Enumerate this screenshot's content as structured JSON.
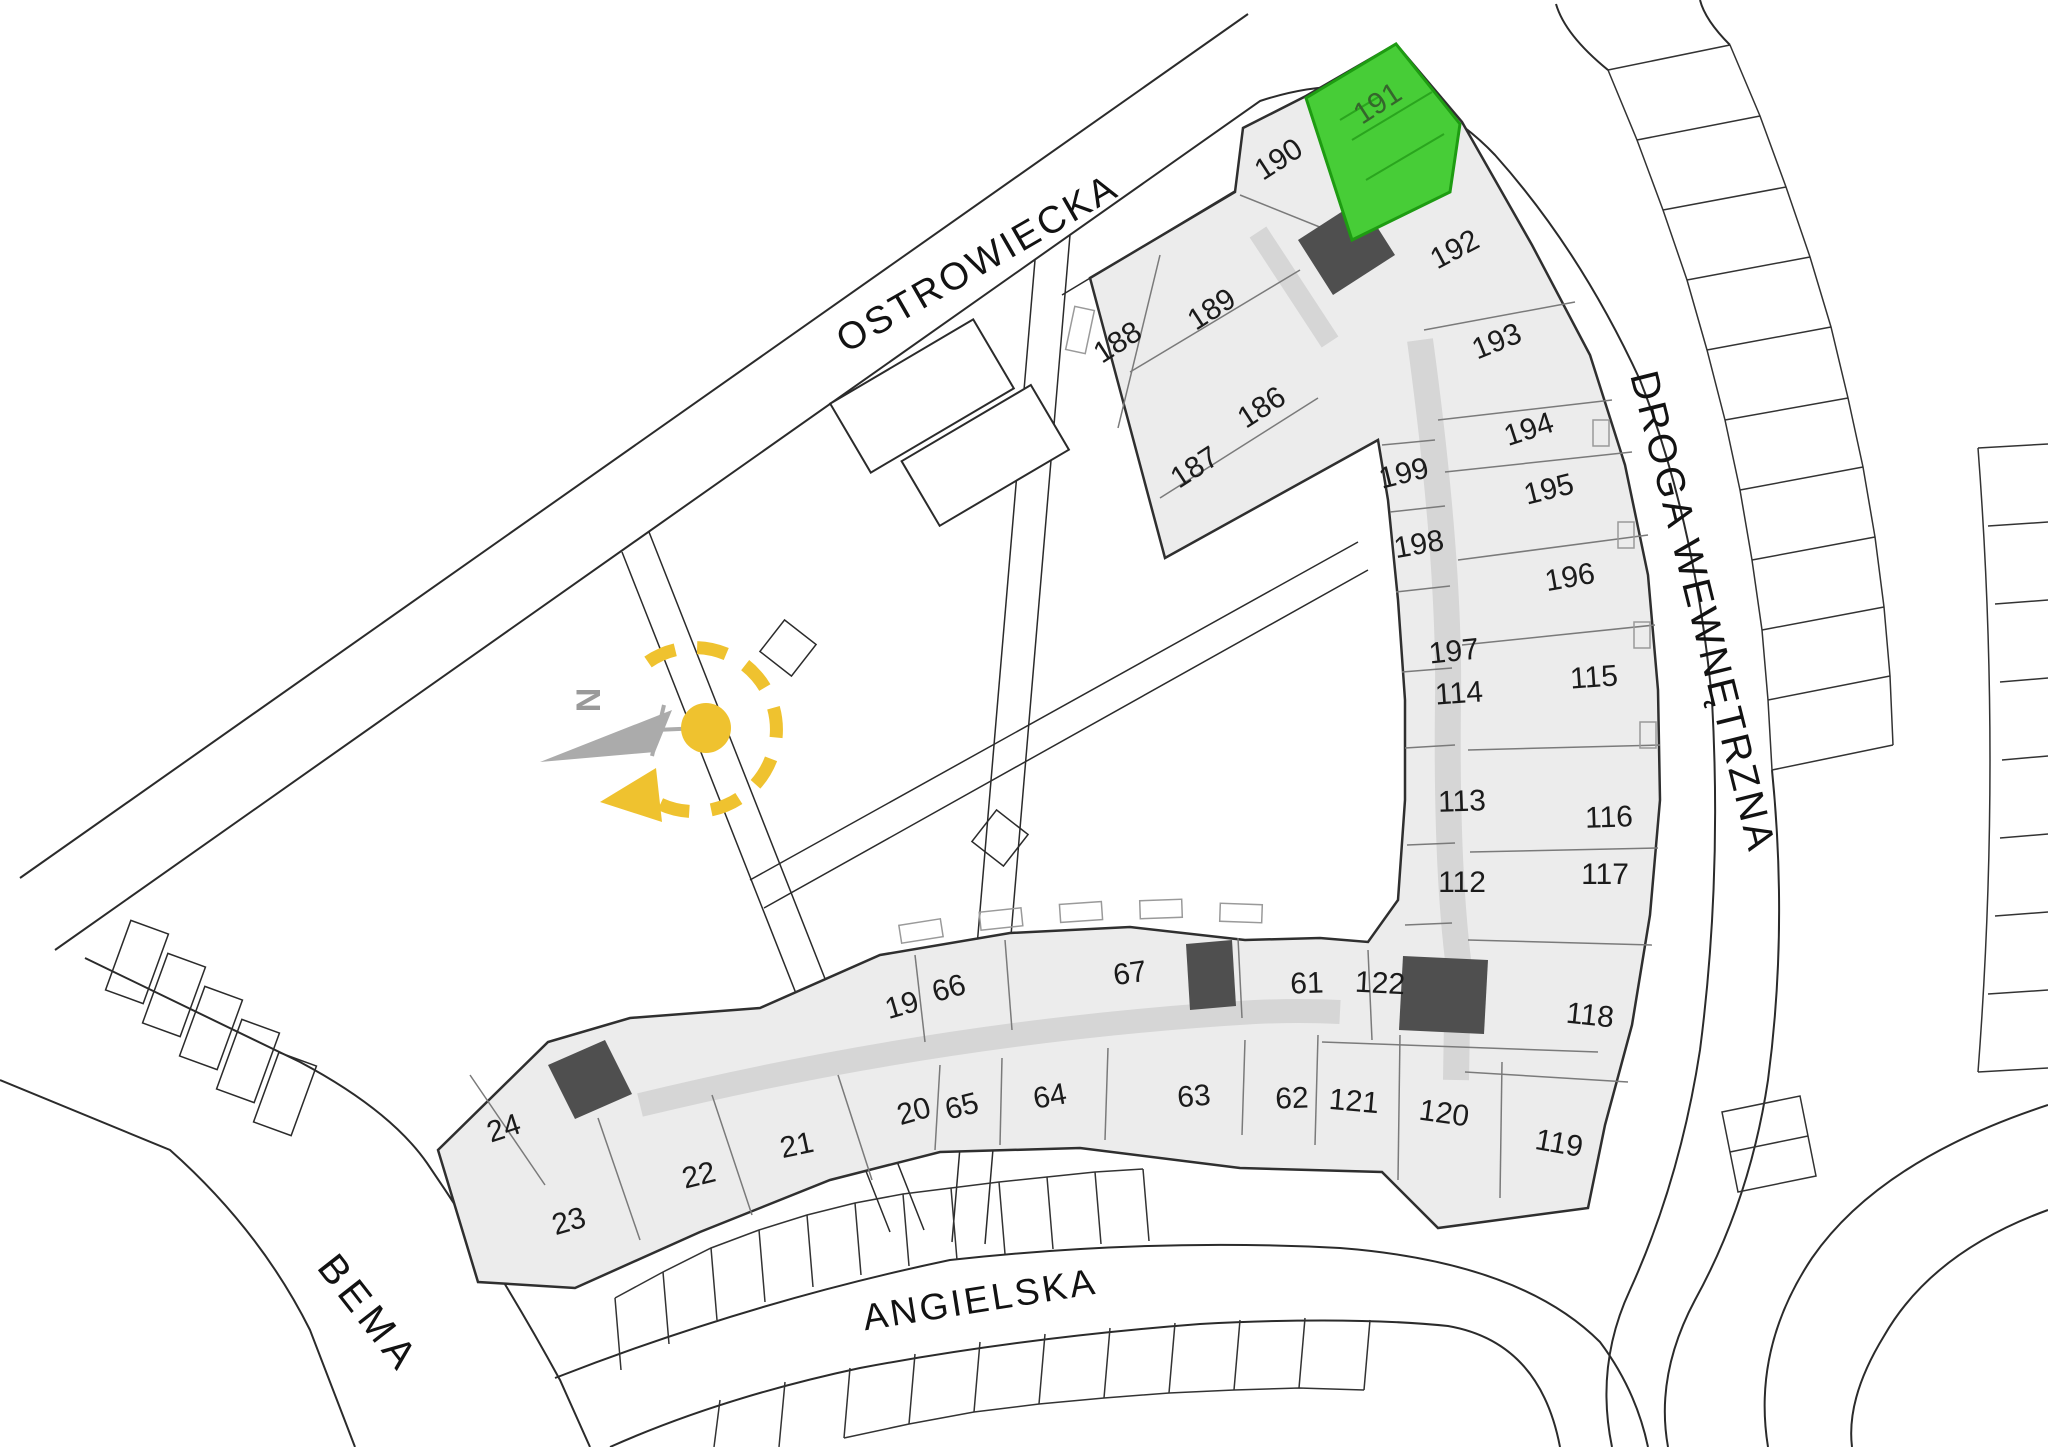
{
  "plan": {
    "type": "residential-site-plan",
    "width": 2048,
    "height": 1447
  },
  "highlighted_unit": {
    "number": "191"
  },
  "compass": {
    "north_label": "N"
  },
  "colors": {
    "highlight_fill": "#47CD37",
    "highlight_stroke": "#1E9C12",
    "highlight_label": "#35662C",
    "compass_accent": "#EFC22F",
    "building_fill": "#ECECEC",
    "wall": "#2F2F2F",
    "label": "#1B1B1B",
    "line": "#2B2B2B"
  },
  "streets": [
    {
      "name": "ostrowiecka",
      "label": "OSTROWIECKA",
      "x": 978,
      "y": 264,
      "rot": -30,
      "size": 38,
      "spacing": 3
    },
    {
      "name": "droga-wewnetrzna",
      "label": "DROGA WEWNĘTRZNA",
      "x": 1702,
      "y": 612,
      "rot": 76,
      "size": 40,
      "spacing": 3
    },
    {
      "name": "angielska",
      "label": "ANGIELSKA",
      "x": 980,
      "y": 1300,
      "rot": -9,
      "size": 37,
      "spacing": 3
    },
    {
      "name": "bema",
      "label": "BEMA",
      "x": 368,
      "y": 1314,
      "rot": 52,
      "size": 40,
      "spacing": 6
    }
  ],
  "units": [
    {
      "number": "188",
      "x": 1118,
      "y": 343,
      "rot": -33
    },
    {
      "number": "189",
      "x": 1212,
      "y": 310,
      "rot": -33
    },
    {
      "number": "186",
      "x": 1262,
      "y": 408,
      "rot": -33
    },
    {
      "number": "187",
      "x": 1195,
      "y": 468,
      "rot": -33
    },
    {
      "number": "190",
      "x": 1279,
      "y": 160,
      "rot": -33
    },
    {
      "number": "191",
      "x": 1378,
      "y": 104,
      "rot": -33,
      "highlighted": true
    },
    {
      "number": "192",
      "x": 1455,
      "y": 250,
      "rot": -28
    },
    {
      "number": "193",
      "x": 1497,
      "y": 342,
      "rot": -22
    },
    {
      "number": "194",
      "x": 1529,
      "y": 430,
      "rot": -18
    },
    {
      "number": "195",
      "x": 1549,
      "y": 490,
      "rot": -14
    },
    {
      "number": "196",
      "x": 1570,
      "y": 578,
      "rot": -10
    },
    {
      "number": "199",
      "x": 1404,
      "y": 474,
      "rot": -14
    },
    {
      "number": "198",
      "x": 1419,
      "y": 545,
      "rot": -10
    },
    {
      "number": "197",
      "x": 1454,
      "y": 652,
      "rot": -6
    },
    {
      "number": "114",
      "x": 1459,
      "y": 694,
      "rot": -4
    },
    {
      "number": "115",
      "x": 1594,
      "y": 678,
      "rot": -4
    },
    {
      "number": "113",
      "x": 1462,
      "y": 802,
      "rot": -2
    },
    {
      "number": "116",
      "x": 1609,
      "y": 818,
      "rot": -2
    },
    {
      "number": "112",
      "x": 1462,
      "y": 883,
      "rot": 0
    },
    {
      "number": "117",
      "x": 1605,
      "y": 875,
      "rot": 0
    },
    {
      "number": "122",
      "x": 1380,
      "y": 984,
      "rot": 3
    },
    {
      "number": "118",
      "x": 1590,
      "y": 1016,
      "rot": 6
    },
    {
      "number": "121",
      "x": 1354,
      "y": 1102,
      "rot": 5
    },
    {
      "number": "120",
      "x": 1444,
      "y": 1114,
      "rot": 8
    },
    {
      "number": "119",
      "x": 1559,
      "y": 1144,
      "rot": 10
    },
    {
      "number": "19",
      "x": 902,
      "y": 1006,
      "rot": -16
    },
    {
      "number": "66",
      "x": 949,
      "y": 989,
      "rot": -16
    },
    {
      "number": "67",
      "x": 1130,
      "y": 974,
      "rot": -8
    },
    {
      "number": "61",
      "x": 1307,
      "y": 984,
      "rot": -2
    },
    {
      "number": "20",
      "x": 914,
      "y": 1112,
      "rot": -16
    },
    {
      "number": "65",
      "x": 962,
      "y": 1107,
      "rot": -14
    },
    {
      "number": "64",
      "x": 1050,
      "y": 1097,
      "rot": -10
    },
    {
      "number": "63",
      "x": 1194,
      "y": 1097,
      "rot": -5
    },
    {
      "number": "62",
      "x": 1292,
      "y": 1099,
      "rot": -2
    },
    {
      "number": "24",
      "x": 504,
      "y": 1129,
      "rot": -18
    },
    {
      "number": "21",
      "x": 797,
      "y": 1146,
      "rot": -12
    },
    {
      "number": "22",
      "x": 699,
      "y": 1176,
      "rot": -14
    },
    {
      "number": "23",
      "x": 569,
      "y": 1222,
      "rot": -16
    }
  ]
}
